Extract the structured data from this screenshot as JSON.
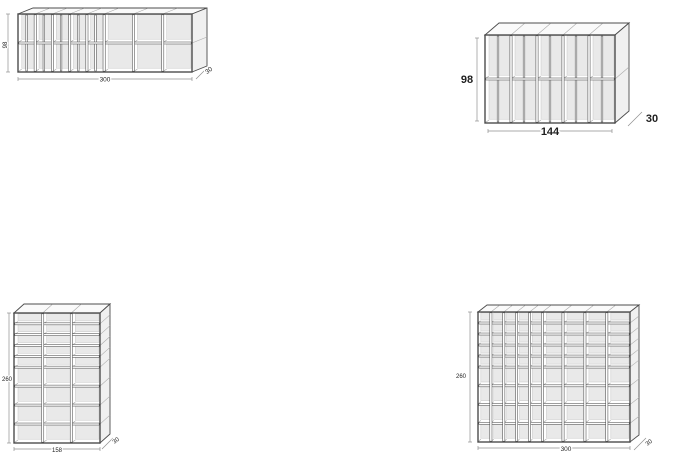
{
  "drawing": {
    "title": "shelving-unit-dimension-diagrams",
    "colors": {
      "line": "#4d4d4d",
      "light_line": "#a8a8a8",
      "panel_fill": "#e9e9e9",
      "panel_edge": "#c7c7c7",
      "face_top": "#fafafa",
      "face_side": "#f0f0f0",
      "dim_line": "#8f8f8f",
      "label": "#1f1f1f"
    },
    "units": [
      {
        "id": "shelf-wide-low",
        "width": "300",
        "height": "98",
        "depth": "30",
        "structure": {
          "col_weights": [
            1,
            1,
            1,
            1,
            1,
            1.7,
            1.7,
            1.7
          ],
          "col_divided": [
            true,
            true,
            true,
            true,
            true,
            false,
            false,
            false
          ],
          "row_weights": [
            1,
            1
          ]
        }
      },
      {
        "id": "shelf-small",
        "width": "144",
        "height": "98",
        "depth": "30",
        "structure": {
          "col_weights": [
            1,
            1,
            1,
            1,
            1
          ],
          "col_divided": [
            true,
            true,
            true,
            true,
            true
          ],
          "row_weights": [
            1,
            1
          ]
        }
      },
      {
        "id": "shelf-tall-narrow",
        "width": "158",
        "height": "260",
        "depth": "30",
        "structure": {
          "col_weights": [
            1,
            1,
            1
          ],
          "col_divided": [
            false,
            false,
            false
          ],
          "row_weights": [
            1,
            1,
            1,
            1,
            1,
            1.75,
            1.75,
            1.75,
            1.75
          ]
        }
      },
      {
        "id": "shelf-tall-wide",
        "width": "300",
        "height": "260",
        "depth": "30",
        "structure": {
          "col_weights": [
            1,
            1,
            1,
            1,
            1,
            1.6,
            1.7,
            1.7,
            1.8
          ],
          "col_divided": [
            false,
            false,
            false,
            false,
            false,
            false,
            false,
            false,
            false
          ],
          "row_weights": [
            1,
            1,
            1,
            1,
            1,
            1.7,
            1.7,
            1.7,
            1.7
          ]
        }
      }
    ]
  }
}
